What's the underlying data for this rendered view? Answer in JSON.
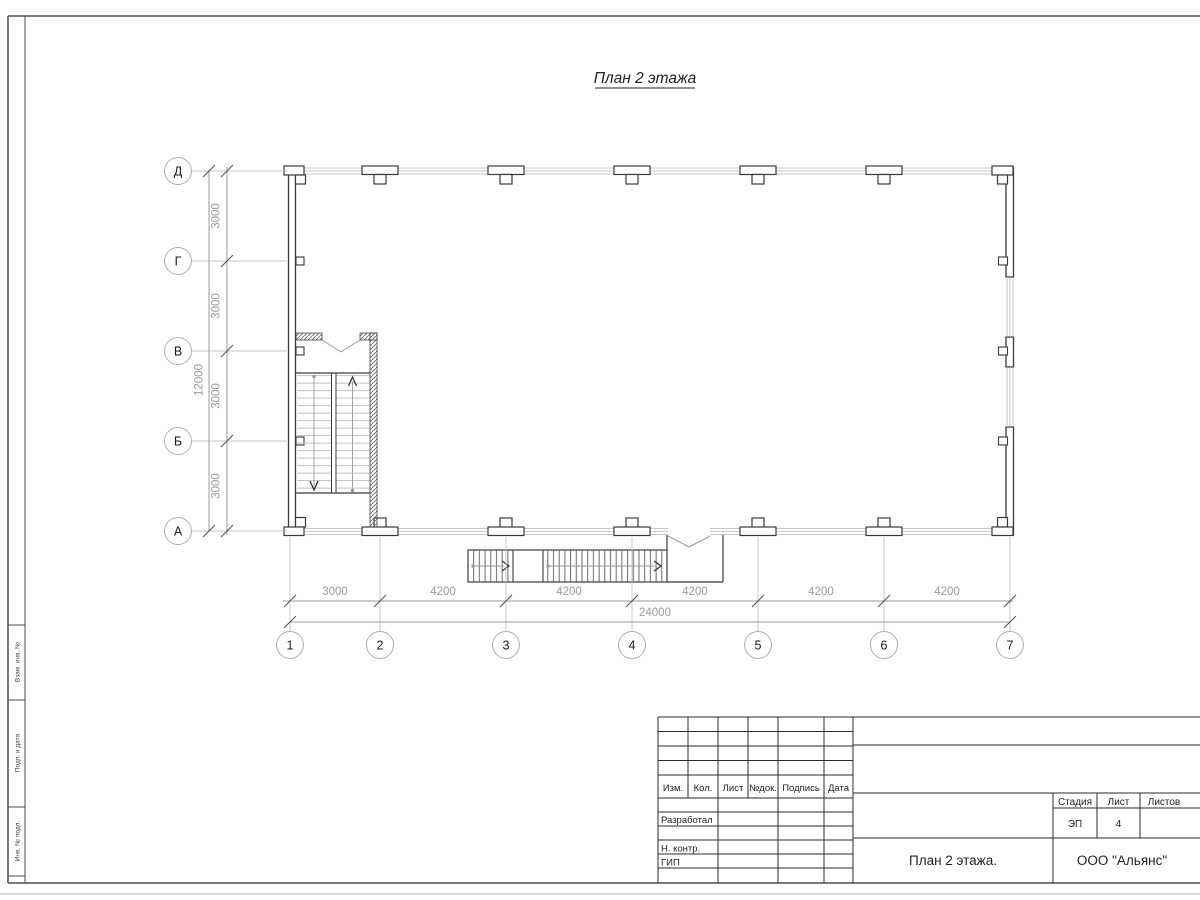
{
  "sheet": {
    "drawing_title": "План 2 этажа",
    "side_labels": [
      "Взам. инв. №",
      "Подп. и дата",
      "Инв. № подл."
    ]
  },
  "grid_axes": {
    "row_labels": [
      "Д",
      "Г",
      "В",
      "Б",
      "А"
    ],
    "col_labels": [
      "1",
      "2",
      "3",
      "4",
      "5",
      "6",
      "7"
    ]
  },
  "dimensions": {
    "vertical_segments": [
      "3000",
      "3000",
      "3000",
      "3000"
    ],
    "vertical_total": "12000",
    "horizontal_segments": [
      "3000",
      "4200",
      "4200",
      "4200",
      "4200",
      "4200"
    ],
    "horizontal_total": "24000"
  },
  "title_block": {
    "revision_headers": [
      "Изм.",
      "Кол.",
      "Лист",
      "№док.",
      "Подпись",
      "Дата"
    ],
    "role_rows": [
      "Разработал",
      "Н. контр.",
      "ГИП"
    ],
    "stage_label": "Стадия",
    "stage_value": "ЭП",
    "sheet_label": "Лист",
    "sheet_value": "4",
    "sheets_label": "Листов",
    "sheets_value": "",
    "drawing_name": "План 2 этажа.",
    "company": "ООО \"Альянс\""
  },
  "colors": {
    "wall_line": "#3a3a3a",
    "thin_line": "#b5b5b5",
    "dim_line": "#999999",
    "dim_text": "#9a9a9a",
    "frame": "#4d4d4d",
    "title_block_line": "#2b2b2b"
  }
}
